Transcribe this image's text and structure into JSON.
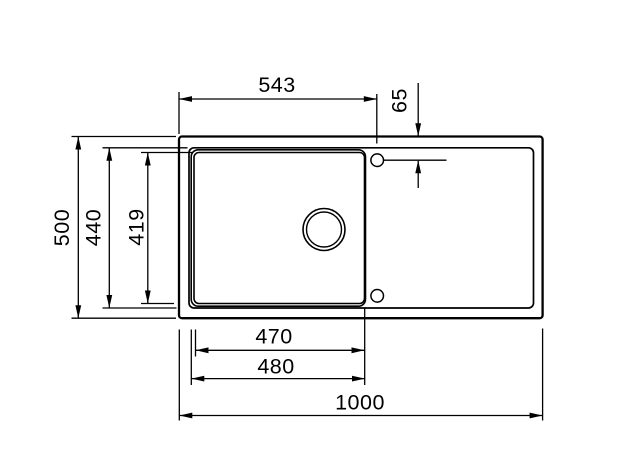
{
  "canvas": {
    "background": "#ffffff",
    "ink": "#000000"
  },
  "drawing": {
    "view": "sink-top-view-dimension-drawing",
    "dimensions": {
      "bowl_axis_from_left": "543",
      "tap_hole_from_top": "65",
      "overall_depth": "500",
      "inner_rim_depth": "440",
      "bowl_inner_depth": "419",
      "bowl_inner_width": "470",
      "bowl_outer_width": "480",
      "overall_width": "1000"
    }
  }
}
